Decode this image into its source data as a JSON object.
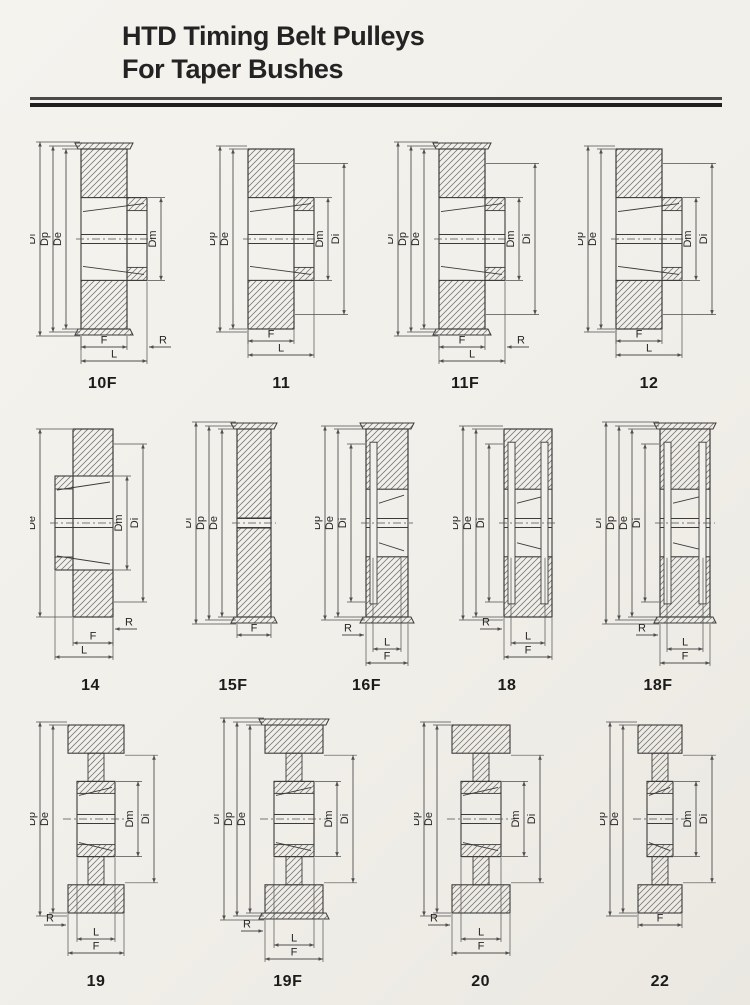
{
  "page": {
    "title_line1": "HTD Timing Belt Pulleys",
    "title_line2": "For Taper Bushes"
  },
  "colors": {
    "paper": "#f2f0ea",
    "line": "#3b3b3b",
    "dim": "#4f4f4f",
    "hatch": "#7a7a7a",
    "text": "#262626",
    "rule_mid": "#4a4a4a",
    "rule_dark": "#1f1f1f"
  },
  "rows": [
    {
      "pulleys": [
        {
          "label": "10F",
          "shape": "hubRight",
          "flanged": true,
          "body_w": 46,
          "ext": 20,
          "left_dims": [
            "Df",
            "Dp",
            "De"
          ],
          "right_dims": [
            "Dm"
          ],
          "bottom_dims": [
            {
              "text": "F",
              "kind": "body",
              "row": 0
            },
            {
              "text": "R",
              "kind": "rRight",
              "row": 0
            },
            {
              "text": "L",
              "kind": "total",
              "row": 1
            }
          ]
        },
        {
          "label": "11",
          "shape": "hubRight",
          "flanged": false,
          "body_w": 46,
          "ext": 20,
          "left_dims": [
            "Dp",
            "De"
          ],
          "right_dims": [
            "Dm",
            "Di"
          ],
          "bottom_dims": [
            {
              "text": "F",
              "kind": "body",
              "row": 0
            },
            {
              "text": "L",
              "kind": "total",
              "row": 1
            }
          ]
        },
        {
          "label": "11F",
          "shape": "hubRight",
          "flanged": true,
          "body_w": 46,
          "ext": 20,
          "left_dims": [
            "Df",
            "Dp",
            "De"
          ],
          "right_dims": [
            "Dm",
            "Di"
          ],
          "bottom_dims": [
            {
              "text": "F",
              "kind": "body",
              "row": 0
            },
            {
              "text": "R",
              "kind": "rRight",
              "row": 0
            },
            {
              "text": "L",
              "kind": "total",
              "row": 1
            }
          ]
        },
        {
          "label": "12",
          "shape": "hubRight",
          "flanged": false,
          "body_w": 46,
          "ext": 20,
          "left_dims": [
            "Dp",
            "De"
          ],
          "right_dims": [
            "Dm",
            "Di"
          ],
          "bottom_dims": [
            {
              "text": "F",
              "kind": "body",
              "row": 0
            },
            {
              "text": "L",
              "kind": "total",
              "row": 1
            }
          ]
        }
      ]
    },
    {
      "pulleys": [
        {
          "label": "14",
          "shape": "hubLeft",
          "flanged": false,
          "body_w": 40,
          "ext": 18,
          "left_dims": [
            "De"
          ],
          "right_dims": [
            "Dm",
            "Di"
          ],
          "bottom_dims": [
            {
              "text": "R",
              "kind": "rRight",
              "row": 0
            },
            {
              "text": "F",
              "kind": "body",
              "row": 1
            },
            {
              "text": "L",
              "kind": "totalLeft",
              "row": 2
            }
          ]
        },
        {
          "label": "15F",
          "shape": "solid",
          "flanged": true,
          "body_w": 34,
          "left_dims": [
            "Df",
            "Dp",
            "De"
          ],
          "right_dims": [],
          "bottom_dims": [
            {
              "text": "F",
              "kind": "body",
              "row": 0
            }
          ]
        },
        {
          "label": "16F",
          "shape": "recessLeft",
          "flanged": true,
          "body_w": 42,
          "left_dims": [
            "Dp",
            "De",
            "Di"
          ],
          "right_dims": [],
          "bottom_dims": [
            {
              "text": "R",
              "kind": "rLeft",
              "row": 0
            },
            {
              "text": "L",
              "kind": "inner",
              "row": 1
            },
            {
              "text": "F",
              "kind": "body",
              "row": 2
            }
          ]
        },
        {
          "label": "18",
          "shape": "recessBoth",
          "flanged": false,
          "body_w": 48,
          "left_dims": [
            "Dp",
            "De",
            "Di"
          ],
          "right_dims": [],
          "bottom_dims": [
            {
              "text": "R",
              "kind": "rLeft",
              "row": 0
            },
            {
              "text": "L",
              "kind": "inner",
              "row": 1
            },
            {
              "text": "F",
              "kind": "body",
              "row": 2
            }
          ]
        },
        {
          "label": "18F",
          "shape": "recessBoth",
          "flanged": true,
          "body_w": 50,
          "left_dims": [
            "Df",
            "Dp",
            "De",
            "Di"
          ],
          "right_dims": [],
          "bottom_dims": [
            {
              "text": "R",
              "kind": "rLeft",
              "row": 0
            },
            {
              "text": "L",
              "kind": "inner",
              "row": 1
            },
            {
              "text": "F",
              "kind": "body",
              "row": 2
            }
          ]
        }
      ]
    },
    {
      "pulleys": [
        {
          "label": "19",
          "shape": "webHub",
          "flanged": false,
          "body_w": 56,
          "left_dims": [
            "Dp",
            "De"
          ],
          "right_dims": [
            "Dm",
            "Di"
          ],
          "bottom_dims": [
            {
              "text": "R",
              "kind": "rLeft",
              "row": 0
            },
            {
              "text": "L",
              "kind": "inner",
              "row": 1
            },
            {
              "text": "F",
              "kind": "body",
              "row": 2
            }
          ]
        },
        {
          "label": "19F",
          "shape": "webHub",
          "flanged": true,
          "body_w": 58,
          "left_dims": [
            "Df",
            "Dp",
            "De"
          ],
          "right_dims": [
            "Dm",
            "Di"
          ],
          "bottom_dims": [
            {
              "text": "R",
              "kind": "rLeft",
              "row": 0
            },
            {
              "text": "L",
              "kind": "inner",
              "row": 1
            },
            {
              "text": "F",
              "kind": "body",
              "row": 2
            }
          ]
        },
        {
          "label": "20",
          "shape": "webHub",
          "flanged": false,
          "body_w": 58,
          "left_dims": [
            "Dp",
            "De"
          ],
          "right_dims": [
            "Dm",
            "Di"
          ],
          "bottom_dims": [
            {
              "text": "R",
              "kind": "rLeft",
              "row": 0
            },
            {
              "text": "L",
              "kind": "inner",
              "row": 1
            },
            {
              "text": "F",
              "kind": "body",
              "row": 2
            }
          ]
        },
        {
          "label": "22",
          "shape": "webHub",
          "flanged": false,
          "body_w": 44,
          "left_dims": [
            "Dp",
            "De"
          ],
          "right_dims": [
            "Dm",
            "Di"
          ],
          "bottom_dims": [
            {
              "text": "F",
              "kind": "body",
              "row": 0
            }
          ]
        }
      ]
    }
  ]
}
